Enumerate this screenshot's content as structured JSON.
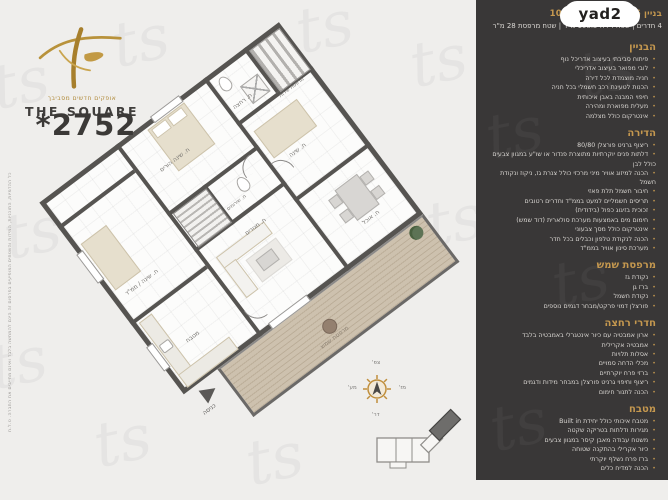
{
  "brand": {
    "tagline": "אופקים חדשים מסביבך",
    "name": "THE SQUARE",
    "phone": "*2752",
    "watermark_glyph": "ts",
    "disclaimer": "כל ההדמיות, התוכניות, המידות והשטחים המופיעים בפרסום זה הינם להמחשה בלבד ואינם מחייבים את החברה. ט.ל.ח"
  },
  "header": {
    "yad2_logo": "yad2",
    "unit_line": "בניין 6 | קומה 5 | דירה 10",
    "details_line": "4 חדרים | שטח דירה 108.5 מ\"ר | שטח מרפסת 28 מ\"ר"
  },
  "specs": {
    "sections": [
      {
        "title": "הבניין",
        "items": [
          "פיתוח סביבתי בעיצוב אדריכל נוף",
          "לובי מפואר בעיצוב אדריכלי",
          "חניה מוצמדת לכל דירה",
          "הכנות לטעינת רכב חשמלי בכל חניה",
          "חיפוי המבנה באבן איכותית",
          "מעלית מפוארת ומהירה",
          "אינטרקום כולל מצלמה"
        ]
      },
      {
        "title": "הדירה",
        "items": [
          "ריצוף גרניט פורצלן 80/80",
          "דלתות פנים יוקרתיות מתוצרת פנדור או שו\"ע במגוון צבעים כולל לבן",
          "הכנה למיזוג אוויר מיני מרכזי כולל צנרת גז, ניקוז ונקודת חשמל",
          "חיבור חשמל תלת פאזי",
          "תריסים חשמליים למעט בממ\"ד וחדרים רטובים",
          "זכוכית בזיגוג כפול (בידודית)",
          "חימום מים באמצעות מערכת סולארית (דוד שמש)",
          "אינטרקום כולל מסך צבעוני",
          "הכנה לנקודת טלפון וכבלים בכל חדר",
          "מערכת סינון אוויר בממ\"ד"
        ]
      },
      {
        "title": "מרפסת שמש",
        "items": [
          "נקודת גז",
          "ברז גן",
          "נקודת חשמל",
          "פורצלן דמוי פרקט/מבחר דגמים נוספים"
        ]
      },
      {
        "title": "חדרי רחצה",
        "items": [
          "ארון אמבטיה עם כיור אינטגרלי באמבטיה בלבד",
          "אמבטיה אקרילית",
          "אסלות תלויות",
          "מכלי הדחה סמויים",
          "ברזי פרח יוקרתיים",
          "ריצוף וחיפוי גרניט פורצלן במבחר מידות ודגמים",
          "הכנה לתנור חימום"
        ]
      },
      {
        "title": "מטבח",
        "items": [
          "מטבח איכותי כולל יחידת Built in",
          "מגירות ודלתות בטריקה שקטה",
          "משטח עבודה מאבן קיסר במגוון צבעים",
          "כיור אקרילי בהתקנה שטוחה",
          "ברז פרח נשלף יוקרתי",
          "הכנה למדיח כלים"
        ]
      }
    ]
  },
  "plan": {
    "rooms": [
      {
        "label": "ח. שינה הורים"
      },
      {
        "label": "ח. רחצה"
      },
      {
        "label": "מרפסת שירות"
      },
      {
        "label": "ח. שינה"
      },
      {
        "label": "ח. שירותים"
      },
      {
        "label": "ח. שינה / ממ\"ד"
      },
      {
        "label": "ח. מגורים"
      },
      {
        "label": "ח. אוכל"
      },
      {
        "label": "מטבח"
      },
      {
        "label": "מרפסת שמש"
      }
    ],
    "entrance_label": "כניסה",
    "compass": {
      "north": "צפ'",
      "south": "דר'",
      "east": "מז'",
      "west": "מע'"
    }
  },
  "colors": {
    "accent_gold": "#c5984f",
    "panel_dark": "#393737",
    "page_bg": "#efeeec",
    "deck_wood": "#c4b7a3"
  }
}
